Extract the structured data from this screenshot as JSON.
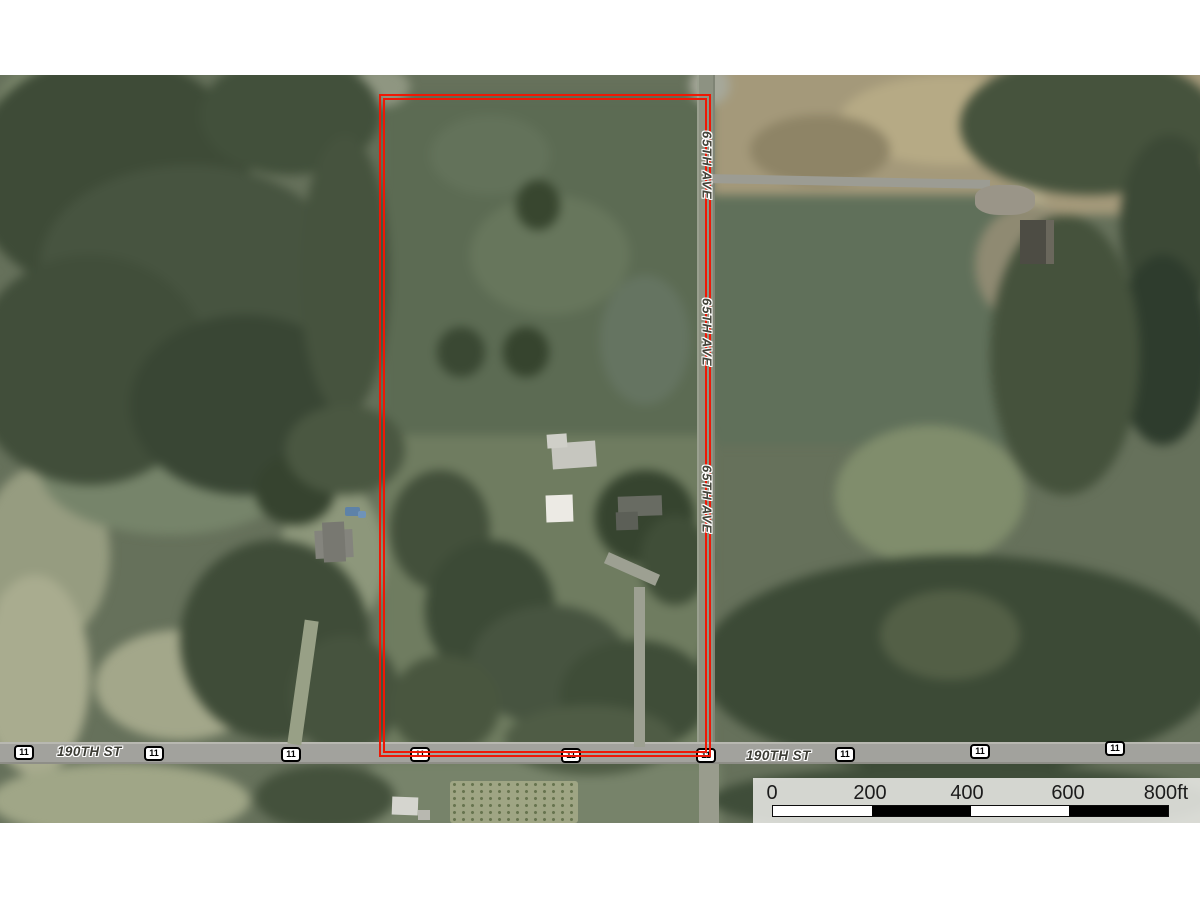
{
  "map": {
    "type": "aerial-parcel-map",
    "boundary_color": "#ee1806",
    "street_labels": [
      {
        "text": "190TH ST",
        "x": 57,
        "y": 744
      },
      {
        "text": "190TH ST",
        "x": 746,
        "y": 748
      }
    ],
    "avenue_labels": [
      {
        "text": "65TH AVE",
        "x": 707,
        "y": 131
      },
      {
        "text": "65TH AVE",
        "x": 707,
        "y": 298
      },
      {
        "text": "65TH AVE",
        "x": 707,
        "y": 465
      }
    ],
    "route_shields": [
      {
        "text": "11",
        "x": 14,
        "y": 745
      },
      {
        "text": "11",
        "x": 144,
        "y": 746
      },
      {
        "text": "11",
        "x": 281,
        "y": 747
      },
      {
        "text": "11",
        "x": 410,
        "y": 747
      },
      {
        "text": "11",
        "x": 561,
        "y": 748
      },
      {
        "text": "11",
        "x": 696,
        "y": 748
      },
      {
        "text": "11",
        "x": 835,
        "y": 747
      },
      {
        "text": "11",
        "x": 970,
        "y": 744
      },
      {
        "text": "11",
        "x": 1105,
        "y": 741
      }
    ]
  },
  "scale_bar": {
    "ticks": [
      {
        "text": "0",
        "x": 772
      },
      {
        "text": "200",
        "x": 870
      },
      {
        "text": "400",
        "x": 967
      },
      {
        "text": "600",
        "x": 1068
      },
      {
        "text": "800ft",
        "x": 1166
      }
    ],
    "segments": [
      {
        "color": "#ffffff"
      },
      {
        "color": "#000000"
      },
      {
        "color": "#ffffff"
      },
      {
        "color": "#000000"
      }
    ]
  }
}
